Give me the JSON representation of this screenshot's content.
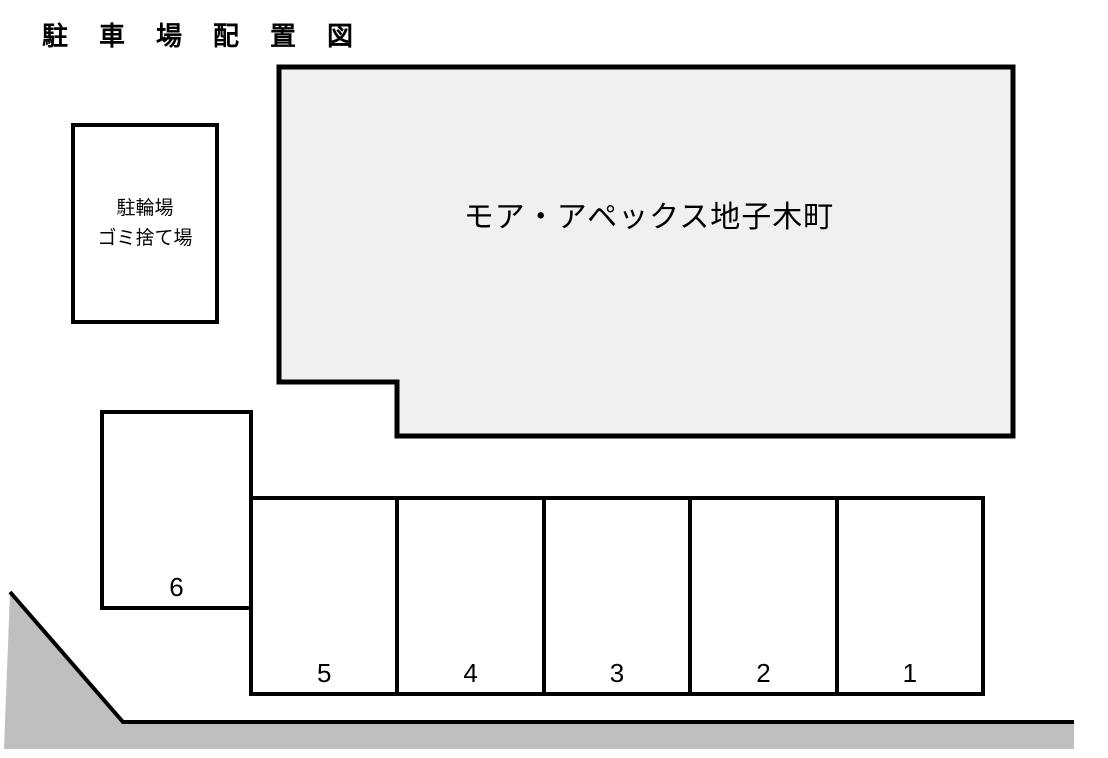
{
  "title": "駐車場配置図",
  "building": {
    "name": "モア・アペックス地子木町"
  },
  "facility_box": {
    "line1": "駐輪場",
    "line2": "ゴミ捨て場"
  },
  "parking": {
    "space_6": {
      "label": "6"
    },
    "row_spaces": [
      {
        "label": "5"
      },
      {
        "label": "4"
      },
      {
        "label": "3"
      },
      {
        "label": "2"
      },
      {
        "label": "1"
      }
    ]
  },
  "colors": {
    "building_fill": "#f0f0f0",
    "road_fill": "#bfbfbf",
    "line": "#000000"
  }
}
